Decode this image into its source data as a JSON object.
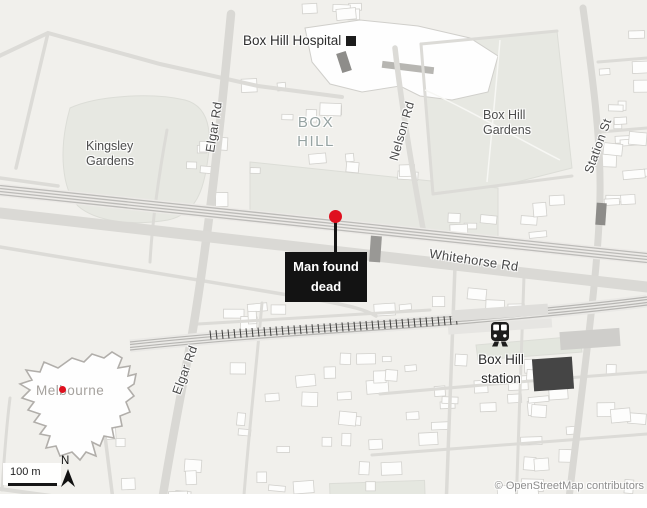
{
  "colors": {
    "background": "#f1f0ec",
    "road": "#dcdbd7",
    "park": "#e7e8e2",
    "water": "#a9c6db",
    "building": "#fdfdfc",
    "railway": "#b7b6b3",
    "marker_red": "#df101e",
    "annotation_bg": "#131313",
    "annotation_text": "#ffffff"
  },
  "labels": {
    "hospital": "Box Hill Hospital",
    "suburb": [
      "BOX",
      "HILL"
    ],
    "kingsley_gardens": [
      "Kingsley",
      "Gardens"
    ],
    "box_hill_gardens": [
      "Box Hill",
      "Gardens"
    ],
    "elgar_rd_north": "Elgar Rd",
    "elgar_rd_south": "Elgar Rd",
    "nelson_rd": "Nelson Rd",
    "station_st": "Station St",
    "whitehorse_rd": "Whitehorse Rd",
    "station": [
      "Box Hill",
      "station"
    ],
    "inset_city": "Melbourne"
  },
  "annotation": {
    "line1": "Man found",
    "line2": "dead"
  },
  "scale": {
    "label": "100 m",
    "north": "N"
  },
  "attribution": "© OpenStreetMap contributors"
}
